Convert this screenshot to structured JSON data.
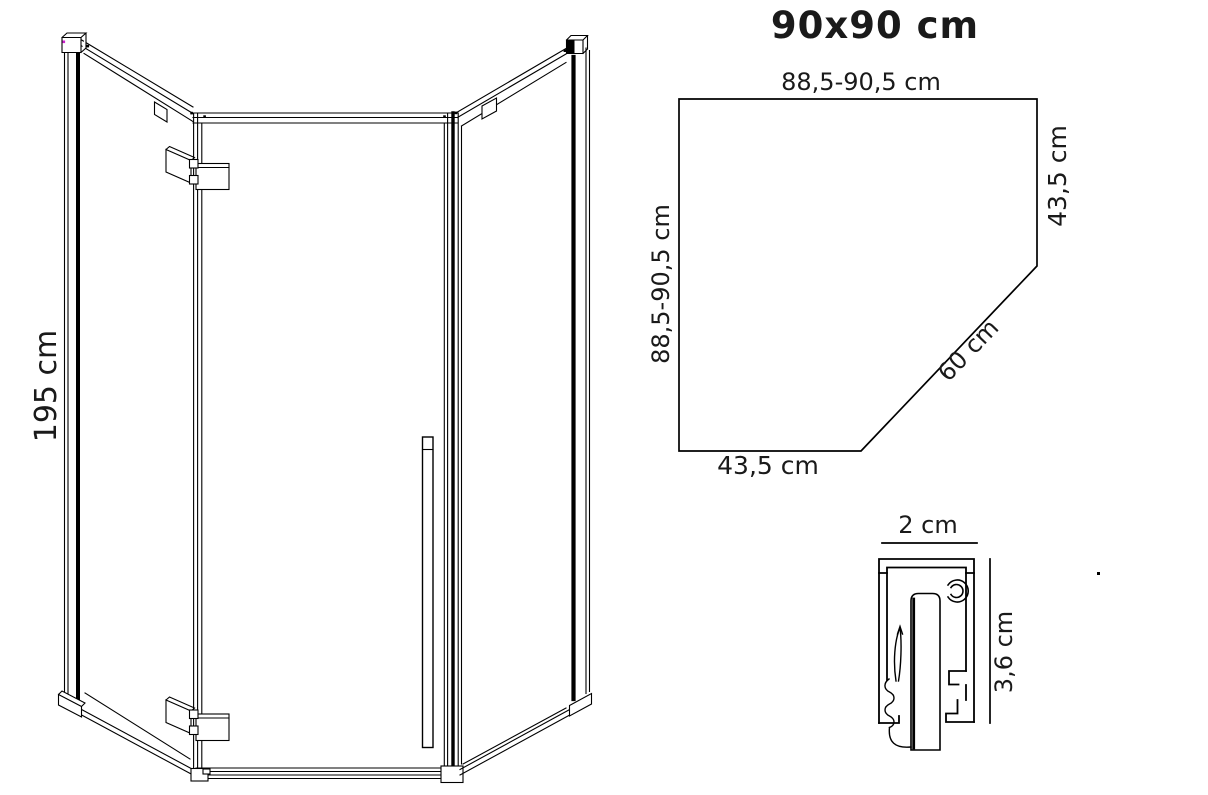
{
  "plan_view": {
    "title": "90x90 cm",
    "labels": {
      "top_width": "88,5-90,5 cm",
      "left_depth": "88,5-90,5 cm",
      "right_side": "43,5 cm",
      "door_diagonal": "60 cm",
      "bottom_front": "43,5 cm"
    }
  },
  "front_view": {
    "labels": {
      "height": "195 cm"
    }
  },
  "profile_detail": {
    "labels": {
      "width": "2 cm",
      "height": "3,6 cm"
    }
  },
  "colors": {
    "line": "#000000",
    "text": "#1a1a1a",
    "background": "#ffffff",
    "corner_artifact": "#cc22cc"
  }
}
